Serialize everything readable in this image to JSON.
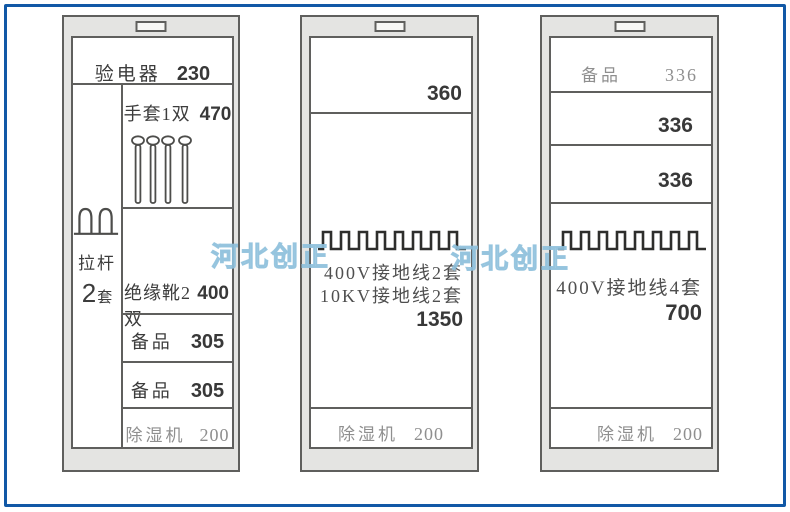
{
  "frame": {
    "border_color": "#1158a6"
  },
  "watermarks": [
    {
      "text": "河北创正"
    },
    {
      "text": "河北创正"
    }
  ],
  "cabinet1": {
    "electroscope": {
      "label": "验电器",
      "value": "230"
    },
    "gloves": {
      "label": "手套1双",
      "value": "470"
    },
    "pull_rod": {
      "label": "拉杆",
      "qty_num": "2",
      "qty_unit": "套"
    },
    "boots": {
      "label": "绝缘靴2双",
      "value": "400"
    },
    "spare_1": {
      "label": "备品",
      "value": "305"
    },
    "spare_2": {
      "label": "备品",
      "value": "305"
    },
    "dehumidifier": {
      "label": "除湿机",
      "value": "200"
    }
  },
  "cabinet2": {
    "top_shelf": {
      "value": "360"
    },
    "grounding": {
      "line1": "400V接地线2套",
      "line2": "10KV接地线2套",
      "value": "1350"
    },
    "dehumidifier": {
      "label": "除湿机",
      "value": "200"
    }
  },
  "cabinet3": {
    "spare_top": {
      "label": "备品",
      "value": "336"
    },
    "shelf_2": {
      "value": "336"
    },
    "shelf_3": {
      "value": "336"
    },
    "grounding": {
      "line1": "400V接地线4套",
      "value": "700"
    },
    "dehumidifier": {
      "label": "除湿机",
      "value": "200"
    }
  }
}
